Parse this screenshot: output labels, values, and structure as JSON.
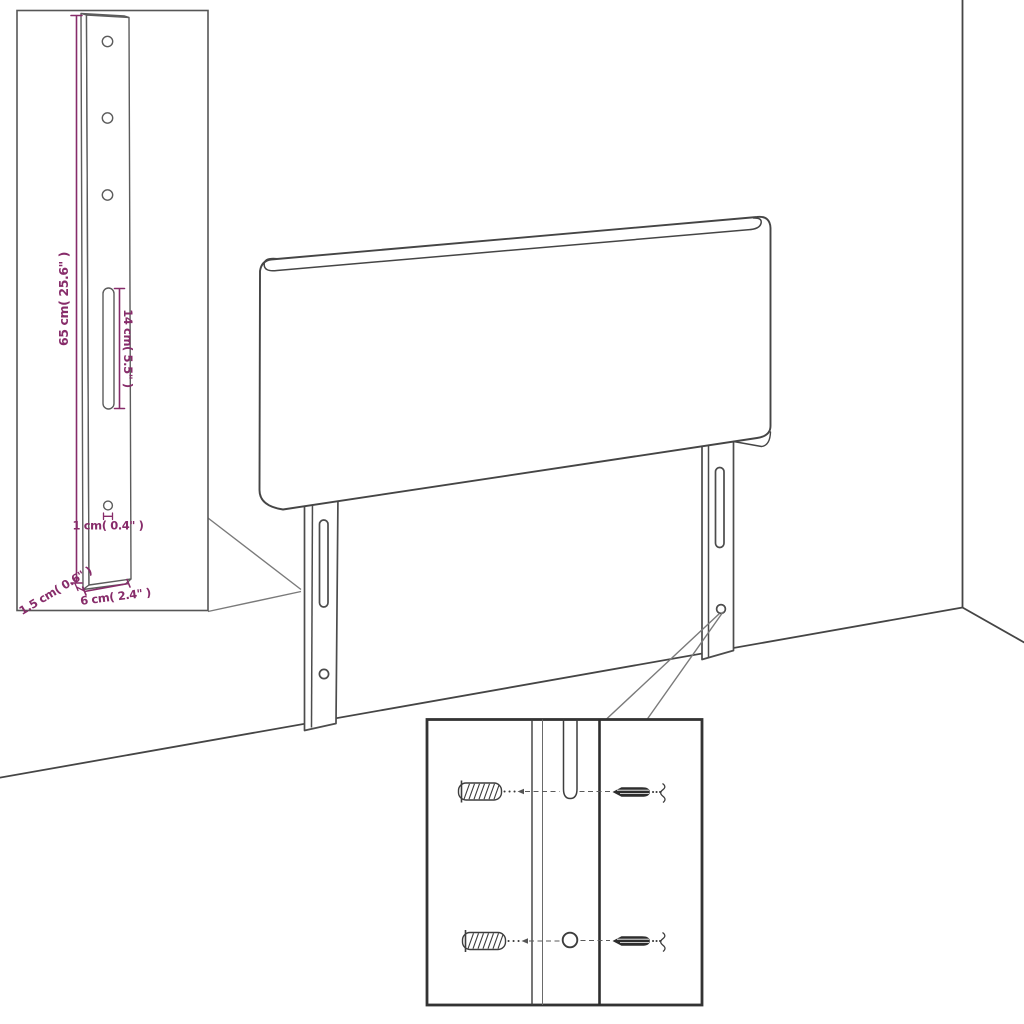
{
  "diagram": {
    "title": "headboard-assembly-diagram",
    "dimensions": {
      "height": "65 cm( 25.6\" )",
      "slot_length": "14 cm( 5.5\" )",
      "hole": "1 cm( 0.4\" )",
      "thickness": "1.5 cm( 0.6\" )",
      "leg_width": "6 cm( 2.4\" )"
    },
    "colors": {
      "dimension": "#872c6a",
      "line": "#454545",
      "background": "#ffffff"
    }
  }
}
